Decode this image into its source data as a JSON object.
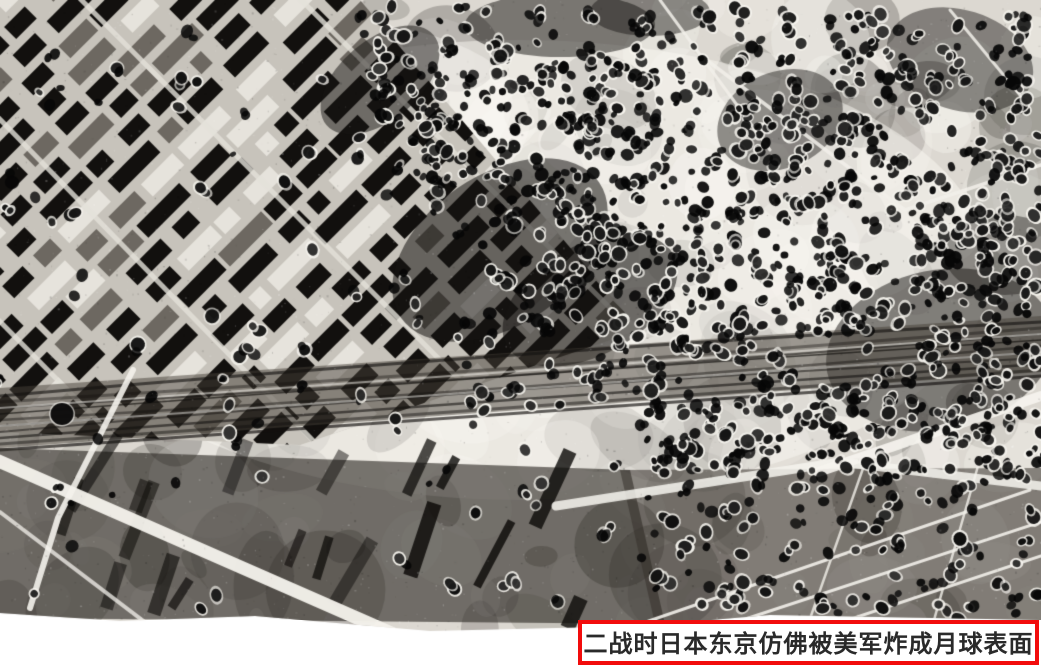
{
  "page": {
    "background_color": "#ffffff",
    "width_px": 1041,
    "height_px": 667
  },
  "photo": {
    "kind": "black-and-white aerial reconnaissance photograph",
    "description": "WWII-era aerial photo of Tokyo, Japan: a dense urban grid in the upper left, a railway corridor running across the middle, and the rest of the ground saturated with dark bomb craters so that it resembles the lunar surface; light diagonal roads cross darker blocks in the lower corners; the bottom edge of the photo is irregular over white paper.",
    "palette": {
      "paper_white": "#ffffff",
      "ground_light": "#dcd8d1",
      "ground_highlight": "#f7f5ef",
      "ground_mid": "#6d6861",
      "ink_black": "#0d0c0b"
    },
    "render": {
      "seed": 11,
      "mottle_blobs": 260,
      "crater_samples": 3400,
      "grain_specks": 2800
    }
  },
  "caption": {
    "text": "二战时日本东京仿佛被美军炸成月球表面",
    "border_color": "#f20c0c",
    "background_color": "#ffffff",
    "text_color": "#2a2a2a"
  }
}
